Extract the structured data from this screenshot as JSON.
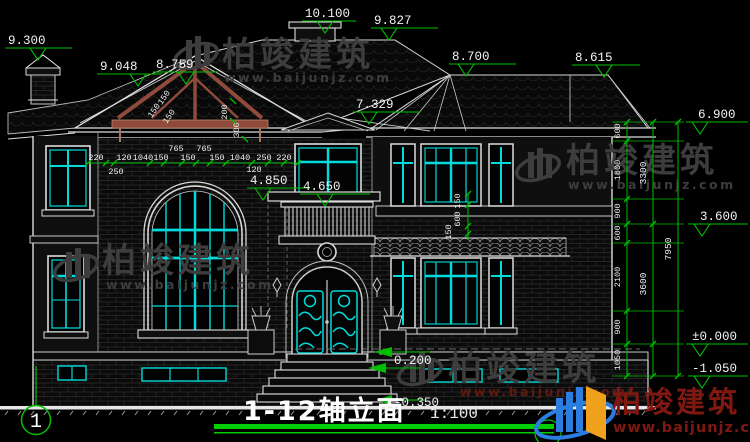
{
  "title": {
    "name": "1-12轴立面",
    "scale": "1:100"
  },
  "axis": {
    "left_bubble": "1"
  },
  "watermark": {
    "brand": "柏竣建筑",
    "url": "www.baijunjz.com"
  },
  "colors": {
    "dimension_green": "#00bf00",
    "window_cyan": "#00dcdc",
    "truss_brown": "#8f4a3c",
    "logo_blue": "#2b7de0",
    "logo_orange": "#f0a11b",
    "logo_red": "#801812"
  },
  "elevations": {
    "chimney_left": "9.300",
    "roof_left": "9.048",
    "gable_edge": "8.759",
    "chimney_top": "10.100",
    "ridge": "9.827",
    "hip_apex": "8.700",
    "ridge_right": "8.615",
    "porch_roof": "7.329",
    "cornice": "4.850",
    "balcony": "4.650",
    "right_l1": "6.900",
    "right_l2": "3.600",
    "right_l3": "±0.000",
    "right_l4": "-1.050",
    "entry_step": "0.200",
    "grade": "-0.350"
  },
  "dims": {
    "top_row": [
      "220",
      "120",
      "1040",
      "150",
      "765",
      "765",
      "150",
      "150",
      "1040",
      "250",
      "220"
    ],
    "second_row": [
      "250",
      "120"
    ],
    "truss": [
      "150",
      "150",
      "150",
      "200",
      "300"
    ],
    "bay": [
      "150",
      "600",
      "150"
    ],
    "right_inner": [
      "600",
      "1800",
      "900",
      "600",
      "2100",
      "900",
      "1050"
    ],
    "right_mid": [
      "3300",
      "3600"
    ],
    "right_total": "7950"
  }
}
